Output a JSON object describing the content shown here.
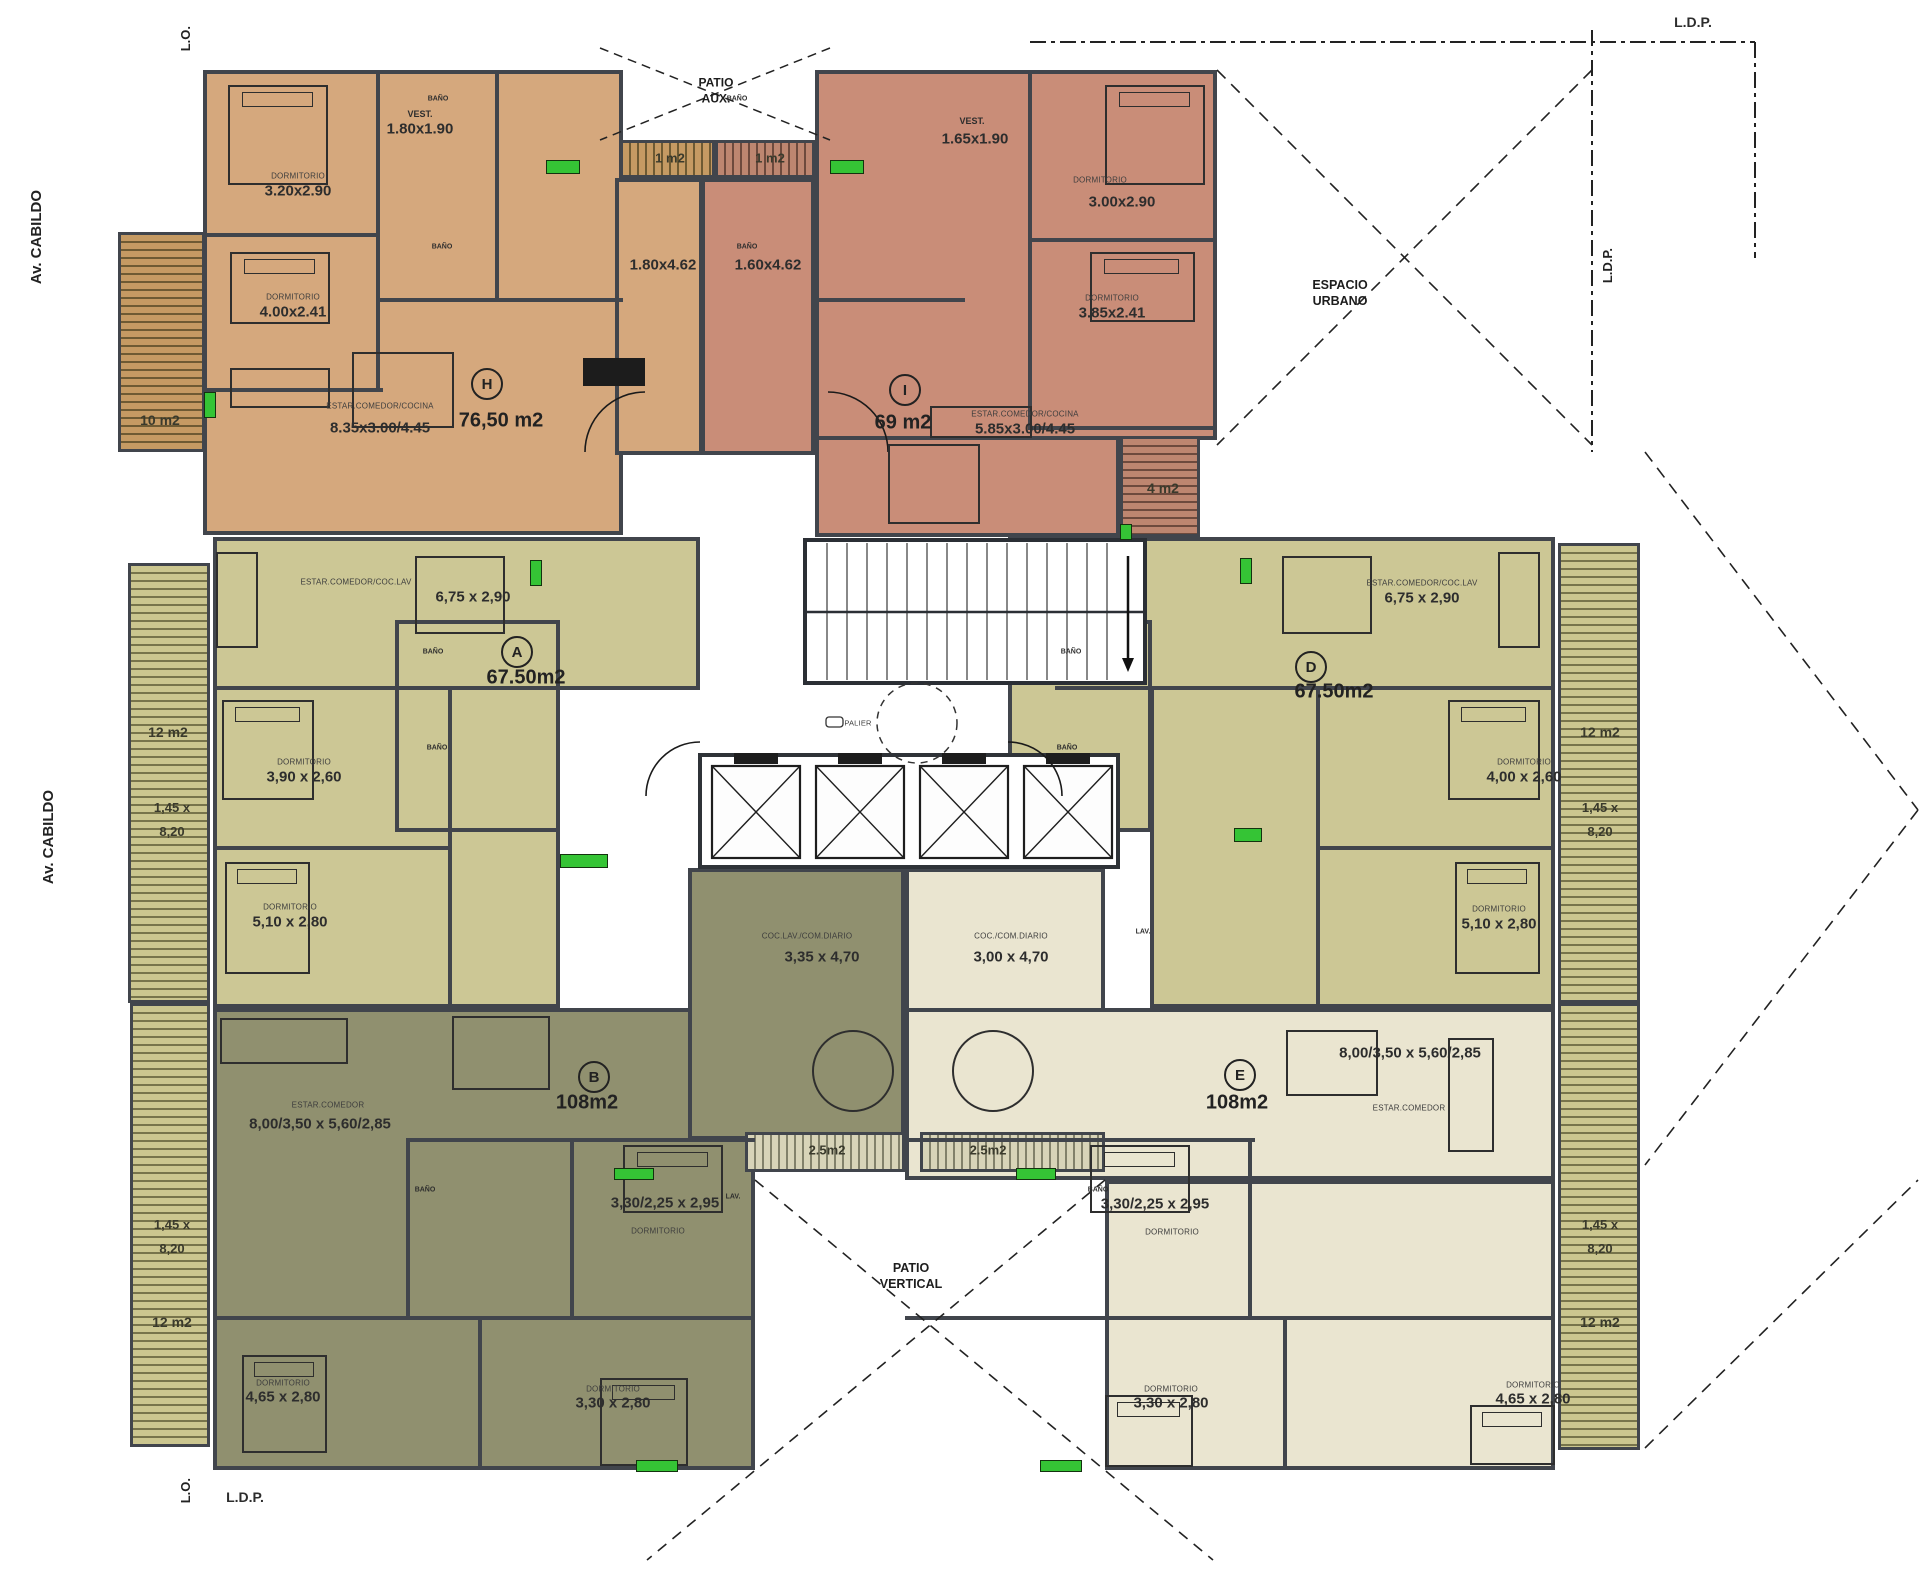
{
  "site": {
    "avenue": "Av. CABILDO",
    "lo": "L.O.",
    "ldp": "L.D.P.",
    "espacio_urbano": "ESPACIO URBANO",
    "patio_aux": "PATIO AUX.",
    "patio_vertical": "PATIO VERTICAL",
    "palier": "PALIER"
  },
  "rooms": {
    "dormitorio": "DORMITORIO",
    "bano": "BAÑO",
    "lav": "LAV."
  },
  "units": {
    "H": {
      "letter": "H",
      "area": "76,50 m2",
      "living_label": "ESTAR.COMEDOR/COCINA",
      "living_dims": "8.35x3.00/4.45",
      "vest_label": "VEST.",
      "vest_dims": "1.80x1.90",
      "dorm1_dims": "3.20x2.90",
      "dorm2_dims": "4.00x2.41",
      "kitchen_dims": "1.80x4.62",
      "balcony_area": "10 m2",
      "patio_balcony_area": "1 m2"
    },
    "I": {
      "letter": "I",
      "area": "69 m2",
      "living_label": "ESTAR.COMEDOR/COCINA",
      "living_dims": "5.85x3.00/4.45",
      "vest_label": "VEST.",
      "vest_dims": "1.65x1.90",
      "dorm1_dims": "3.00x2.90",
      "dorm2_dims": "3.85x2.41",
      "kitchen_dims": "1.60x4.62",
      "balcony_area": "4 m2",
      "patio_balcony_area": "1 m2"
    },
    "A": {
      "letter": "A",
      "area": "67.50m2",
      "living_label": "ESTAR.COMEDOR/COC.LAV",
      "living_dims": "6,75 x 2,90",
      "dorm1_dims": "3,90 x 2,60",
      "dorm2_dims": "5,10 x 2,80",
      "balcony_area": "12 m2",
      "balcony_dims": "1,45 x 8,20"
    },
    "D": {
      "letter": "D",
      "area": "67.50m2",
      "living_label": "ESTAR.COMEDOR/COC.LAV",
      "living_dims": "6,75 x 2,90",
      "dorm1_dims": "4,00 x 2,60",
      "dorm2_dims": "5,10 x 2,80",
      "balcony_area": "12 m2",
      "balcony_dims": "1,45 x 8,20"
    },
    "B": {
      "letter": "B",
      "area": "108m2",
      "living_label": "ESTAR.COMEDOR",
      "living_dims": "8,00/3,50 x 5,60/2,85",
      "kitchen_label": "COC.LAV./COM.DIARIO",
      "kitchen_dims": "3,35 x 4,70",
      "dorm1_dims": "3,30/2,25 x 2,95",
      "dorm2_dims": "3,30 x 2,80",
      "dorm3_dims": "4,65 x 2,80",
      "balcony_area": "12 m2",
      "balcony_dims": "1,45 x 8,20",
      "patio_balcony_area": "2.5m2"
    },
    "E": {
      "letter": "E",
      "area": "108m2",
      "living_label": "ESTAR.COMEDOR",
      "living_dims": "8,00/3,50 x 5,60/2,85",
      "kitchen_label": "COC./COM.DIARIO",
      "kitchen_dims": "3,00 x 4,70",
      "dorm1_dims": "3,30/2,25 x 2,95",
      "dorm2_dims": "3,30 x 2,80",
      "dorm3_dims": "4,65 x 2,80",
      "balcony_area": "12 m2",
      "balcony_dims": "1,45 x 8,20",
      "patio_balcony_area": "2.5m2"
    }
  },
  "colors": {
    "unit_h": "#d5a87d",
    "unit_i": "#c98d78",
    "unit_ad": "#ccc795",
    "unit_b": "#90906f",
    "unit_e": "#eae5d0",
    "walls": "#41454c",
    "window_marker": "#35c435"
  }
}
